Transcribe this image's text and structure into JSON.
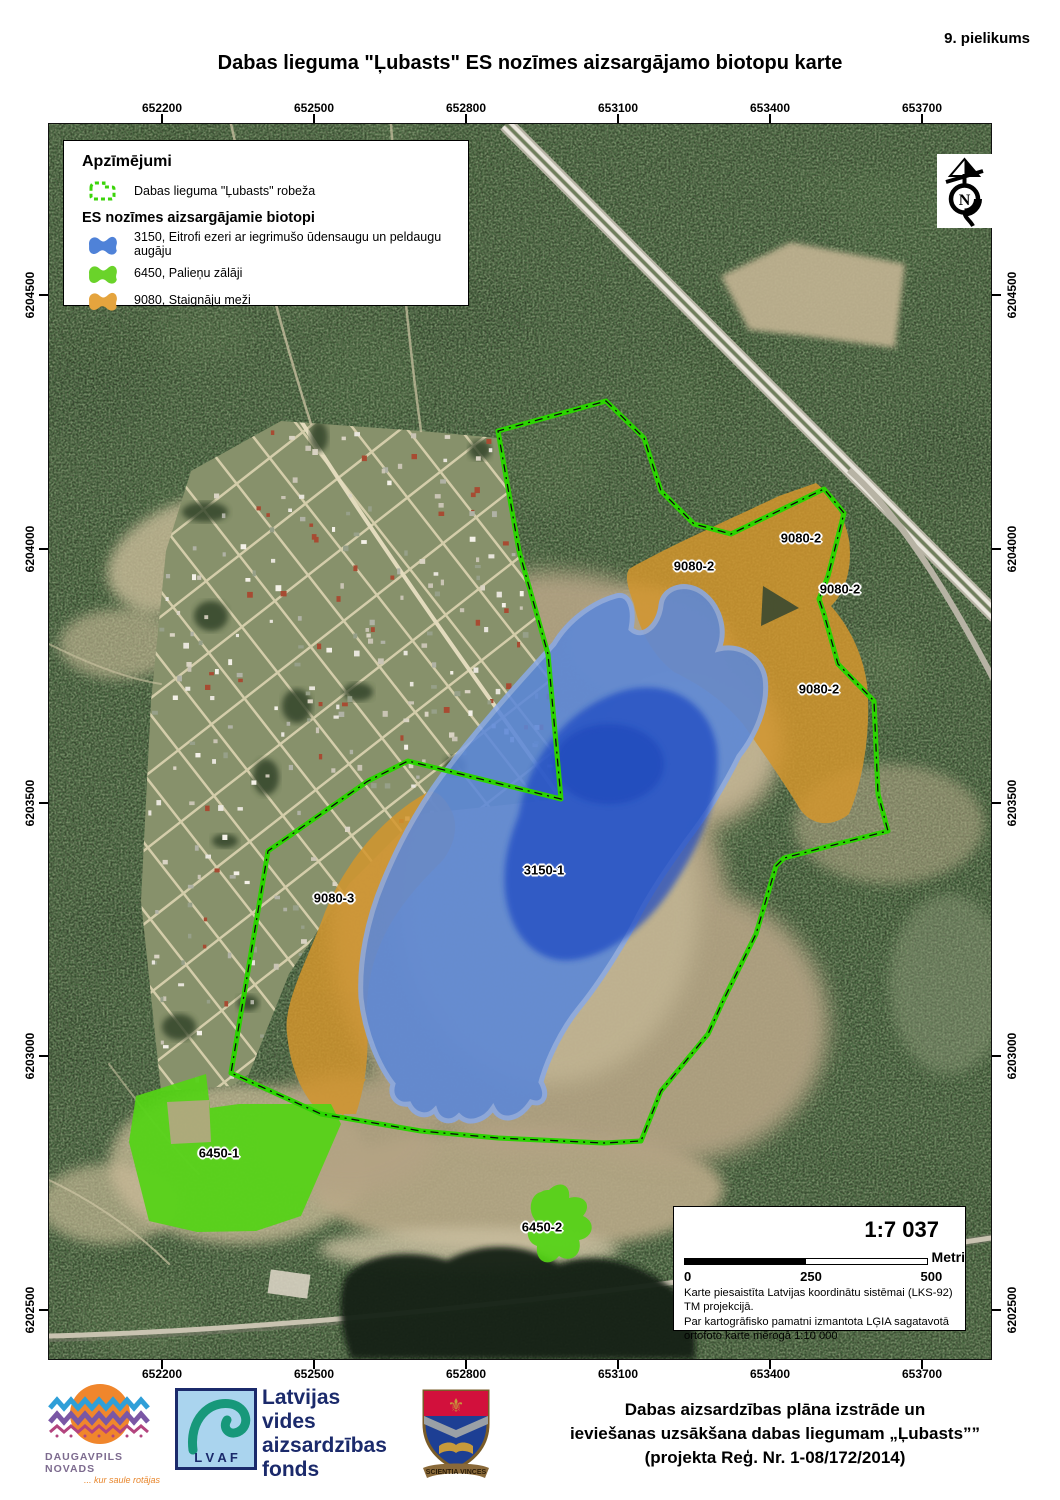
{
  "page": {
    "appendix": "9. pielikums",
    "title": "Dabas lieguma \"Ļubasts\" ES nozīmes aizsargājamo biotopu karte"
  },
  "legend": {
    "heading": "Apzīmējumi",
    "boundary_label": "Dabas lieguma \"Ļubasts\" robeža",
    "subheading": "ES nozīmes aizsargājamie biotopi",
    "boundary_color": "#3bd40a",
    "items": [
      {
        "label": "3150, Eitrofi ezeri ar iegrimušo ūdensaugu un peldaugu augāju",
        "color": "#4f82d8"
      },
      {
        "label": "6450, Palieņu zālāji",
        "color": "#6ad32a"
      },
      {
        "label": "9080, Staignāju meži",
        "color": "#e5a43e"
      }
    ]
  },
  "map": {
    "labels": [
      {
        "text": "9080-2",
        "x": 800,
        "y": 537
      },
      {
        "text": "9080-2",
        "x": 693,
        "y": 565
      },
      {
        "text": "9080-2",
        "x": 839,
        "y": 588
      },
      {
        "text": "9080-2",
        "x": 818,
        "y": 688
      },
      {
        "text": "9080-3",
        "x": 333,
        "y": 897
      },
      {
        "text": "3150-1",
        "x": 543,
        "y": 869
      },
      {
        "text": "6450-1",
        "x": 218,
        "y": 1152
      },
      {
        "text": "6450-2",
        "x": 541,
        "y": 1226
      }
    ],
    "axis": {
      "x": {
        "labels": [
          "652200",
          "652500",
          "652800",
          "653100",
          "653400",
          "653700"
        ],
        "px": [
          162,
          314,
          466,
          618,
          770,
          922
        ]
      },
      "y": {
        "labels": [
          "6204500",
          "6204000",
          "6203500",
          "6203000",
          "6202500"
        ],
        "px": [
          295,
          549,
          803,
          1056,
          1310
        ]
      }
    }
  },
  "scale": {
    "ratio": "1:7 037",
    "bar": {
      "start": "0",
      "mid": "250",
      "end": "500",
      "unit": "Metri"
    },
    "note1": "Karte piesaistīta Latvijas koordinātu sistēmai (LKS-92) TM projekcijā.",
    "note2": "Par kartogrāfisko pamatni izmantota LĢIA sagatavotā ortofoto karte mērogā 1:10 000"
  },
  "north_arrow": {
    "letter": "N"
  },
  "footer": {
    "daugavpils": {
      "name": "DAUGAVPILS NOVADS",
      "tagline": "... kur saule rotājas"
    },
    "lvaf": {
      "abbr": "L V A F",
      "name_lines": [
        "Latvijas",
        "vides",
        "aizsardzības",
        "fonds"
      ]
    },
    "crest_motto": "SCIENTIA VINCES",
    "project_lines": [
      "Dabas aizsardzības plāna izstrāde un",
      "ieviešanas uzsākšana dabas liegumam „Ļubasts””",
      "(projekta Reģ. Nr. 1-08/172/2014)"
    ]
  }
}
